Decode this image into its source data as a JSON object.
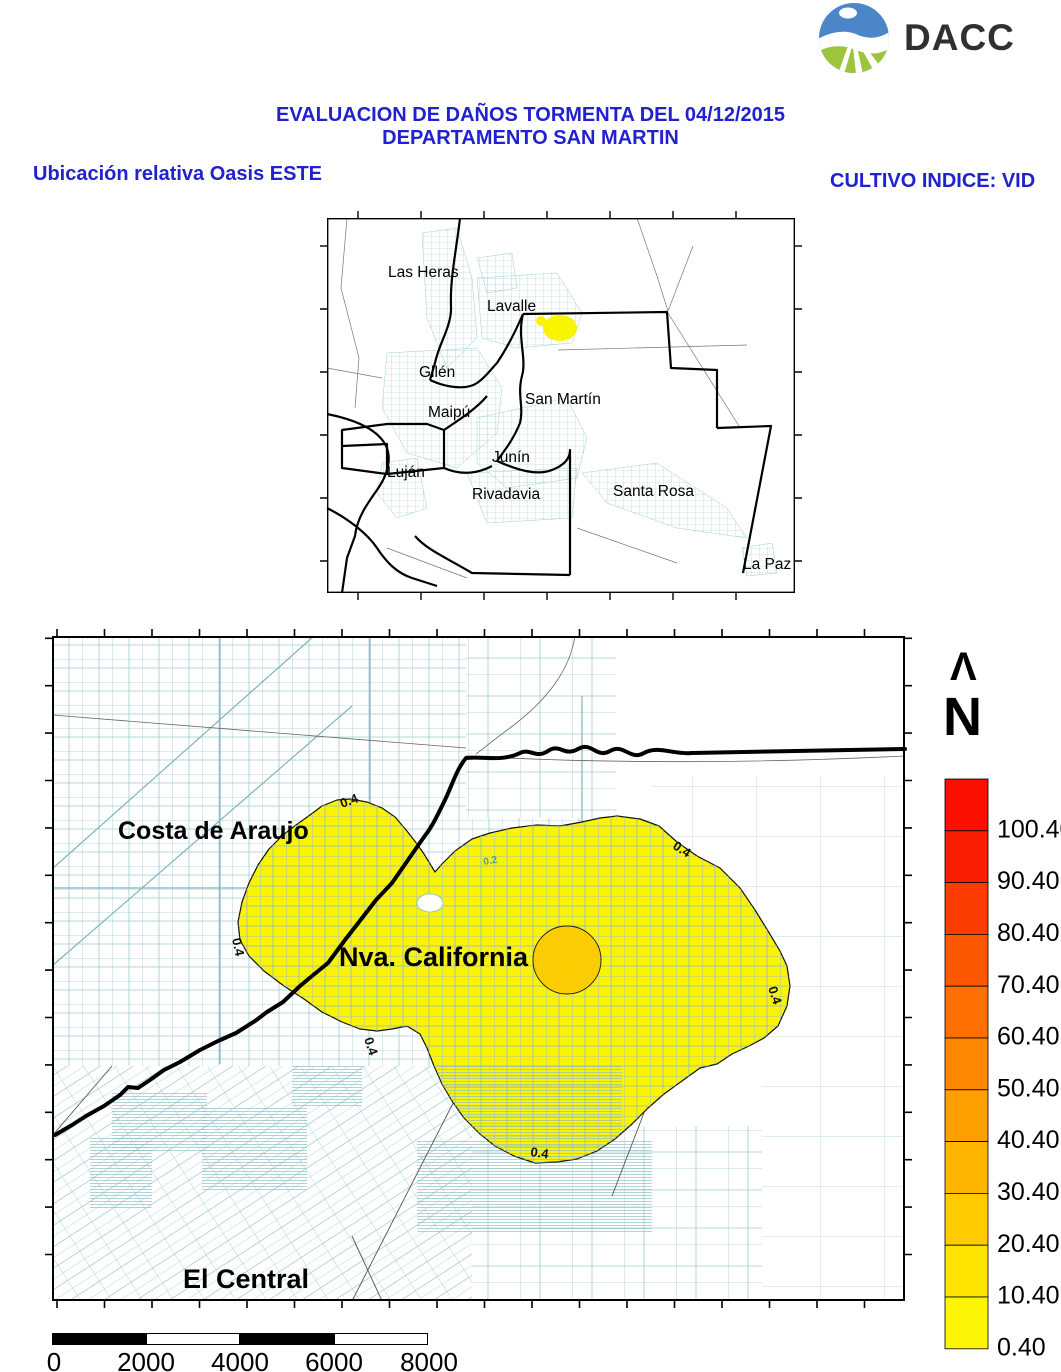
{
  "header": {
    "logo_text": "DACC",
    "title_line1": "EVALUACION DE DAÑOS TORMENTA DEL 04/12/2015",
    "title_line2": "DEPARTAMENTO SAN MARTIN",
    "subtitle_left": "Ubicación relativa Oasis ESTE",
    "subtitle_right": "CULTIVO INDICE: VID"
  },
  "colors": {
    "title_blue": "#2121cf",
    "parcel_teal": "#9fccce",
    "parcel_blue_in_damage": "#96b6d6",
    "damage_yellow": "#faf400",
    "damage_gold": "#fbca00",
    "river_black": "#000000"
  },
  "inset_map": {
    "labels": [
      "Las Heras",
      "Lavalle",
      "Gllén",
      "Maipú",
      "San Martín",
      "Junín",
      "Luján",
      "Rivadavia",
      "Santa Rosa",
      "La Paz"
    ]
  },
  "main_map": {
    "labels": [
      "Costa de Araujo",
      "Nva. California",
      "El Central"
    ],
    "contour_label": "0.4",
    "contour_label_minor": "0.2",
    "north_caret": "Λ",
    "north_letter": "N"
  },
  "legend": {
    "values": [
      "100.40",
      "90.40",
      "80.40",
      "70.40",
      "60.40",
      "50.40",
      "40.40",
      "30.40",
      "20.40",
      "10.40",
      "0.40"
    ],
    "colors": [
      "#fa0f00",
      "#fb1d00",
      "#fb3c00",
      "#fc5800",
      "#fc6f00",
      "#fd8700",
      "#fd9f00",
      "#fdb500",
      "#fecb00",
      "#fee200",
      "#fdf505"
    ]
  },
  "scale_bar": {
    "labels": [
      "0",
      "2000",
      "4000",
      "6000",
      "8000"
    ]
  }
}
